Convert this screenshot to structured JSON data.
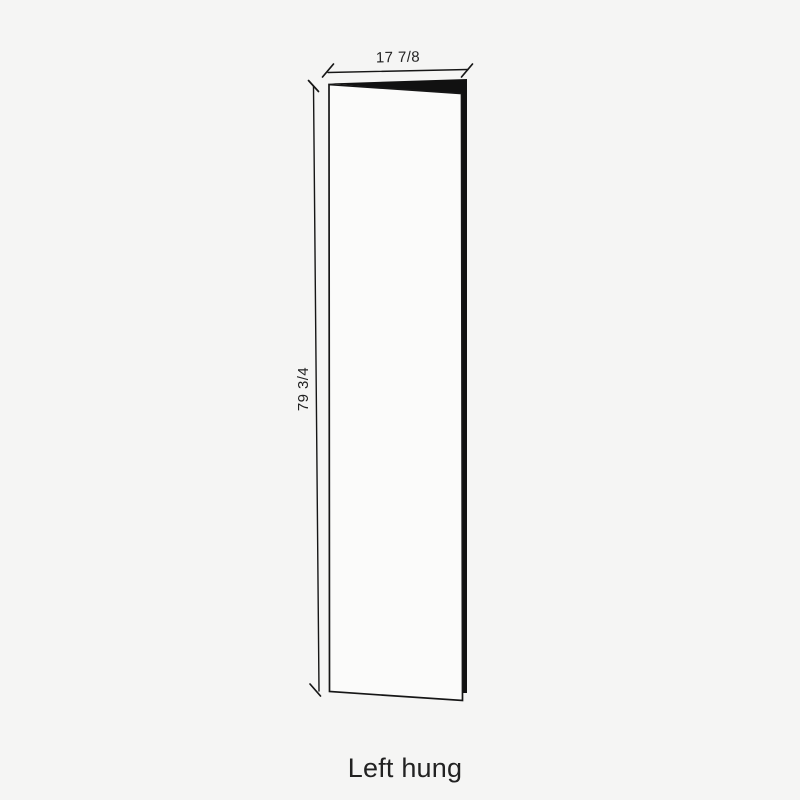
{
  "page": {
    "background_color": "#f5f5f4"
  },
  "diagram": {
    "caption": "Left hung",
    "dimensions": {
      "width_label": "17 7/8",
      "height_label": "79 3/4"
    },
    "colors": {
      "line": "#161616",
      "door_face": "#fbfbfa",
      "door_edge": "#111111",
      "text": "#222222"
    }
  }
}
